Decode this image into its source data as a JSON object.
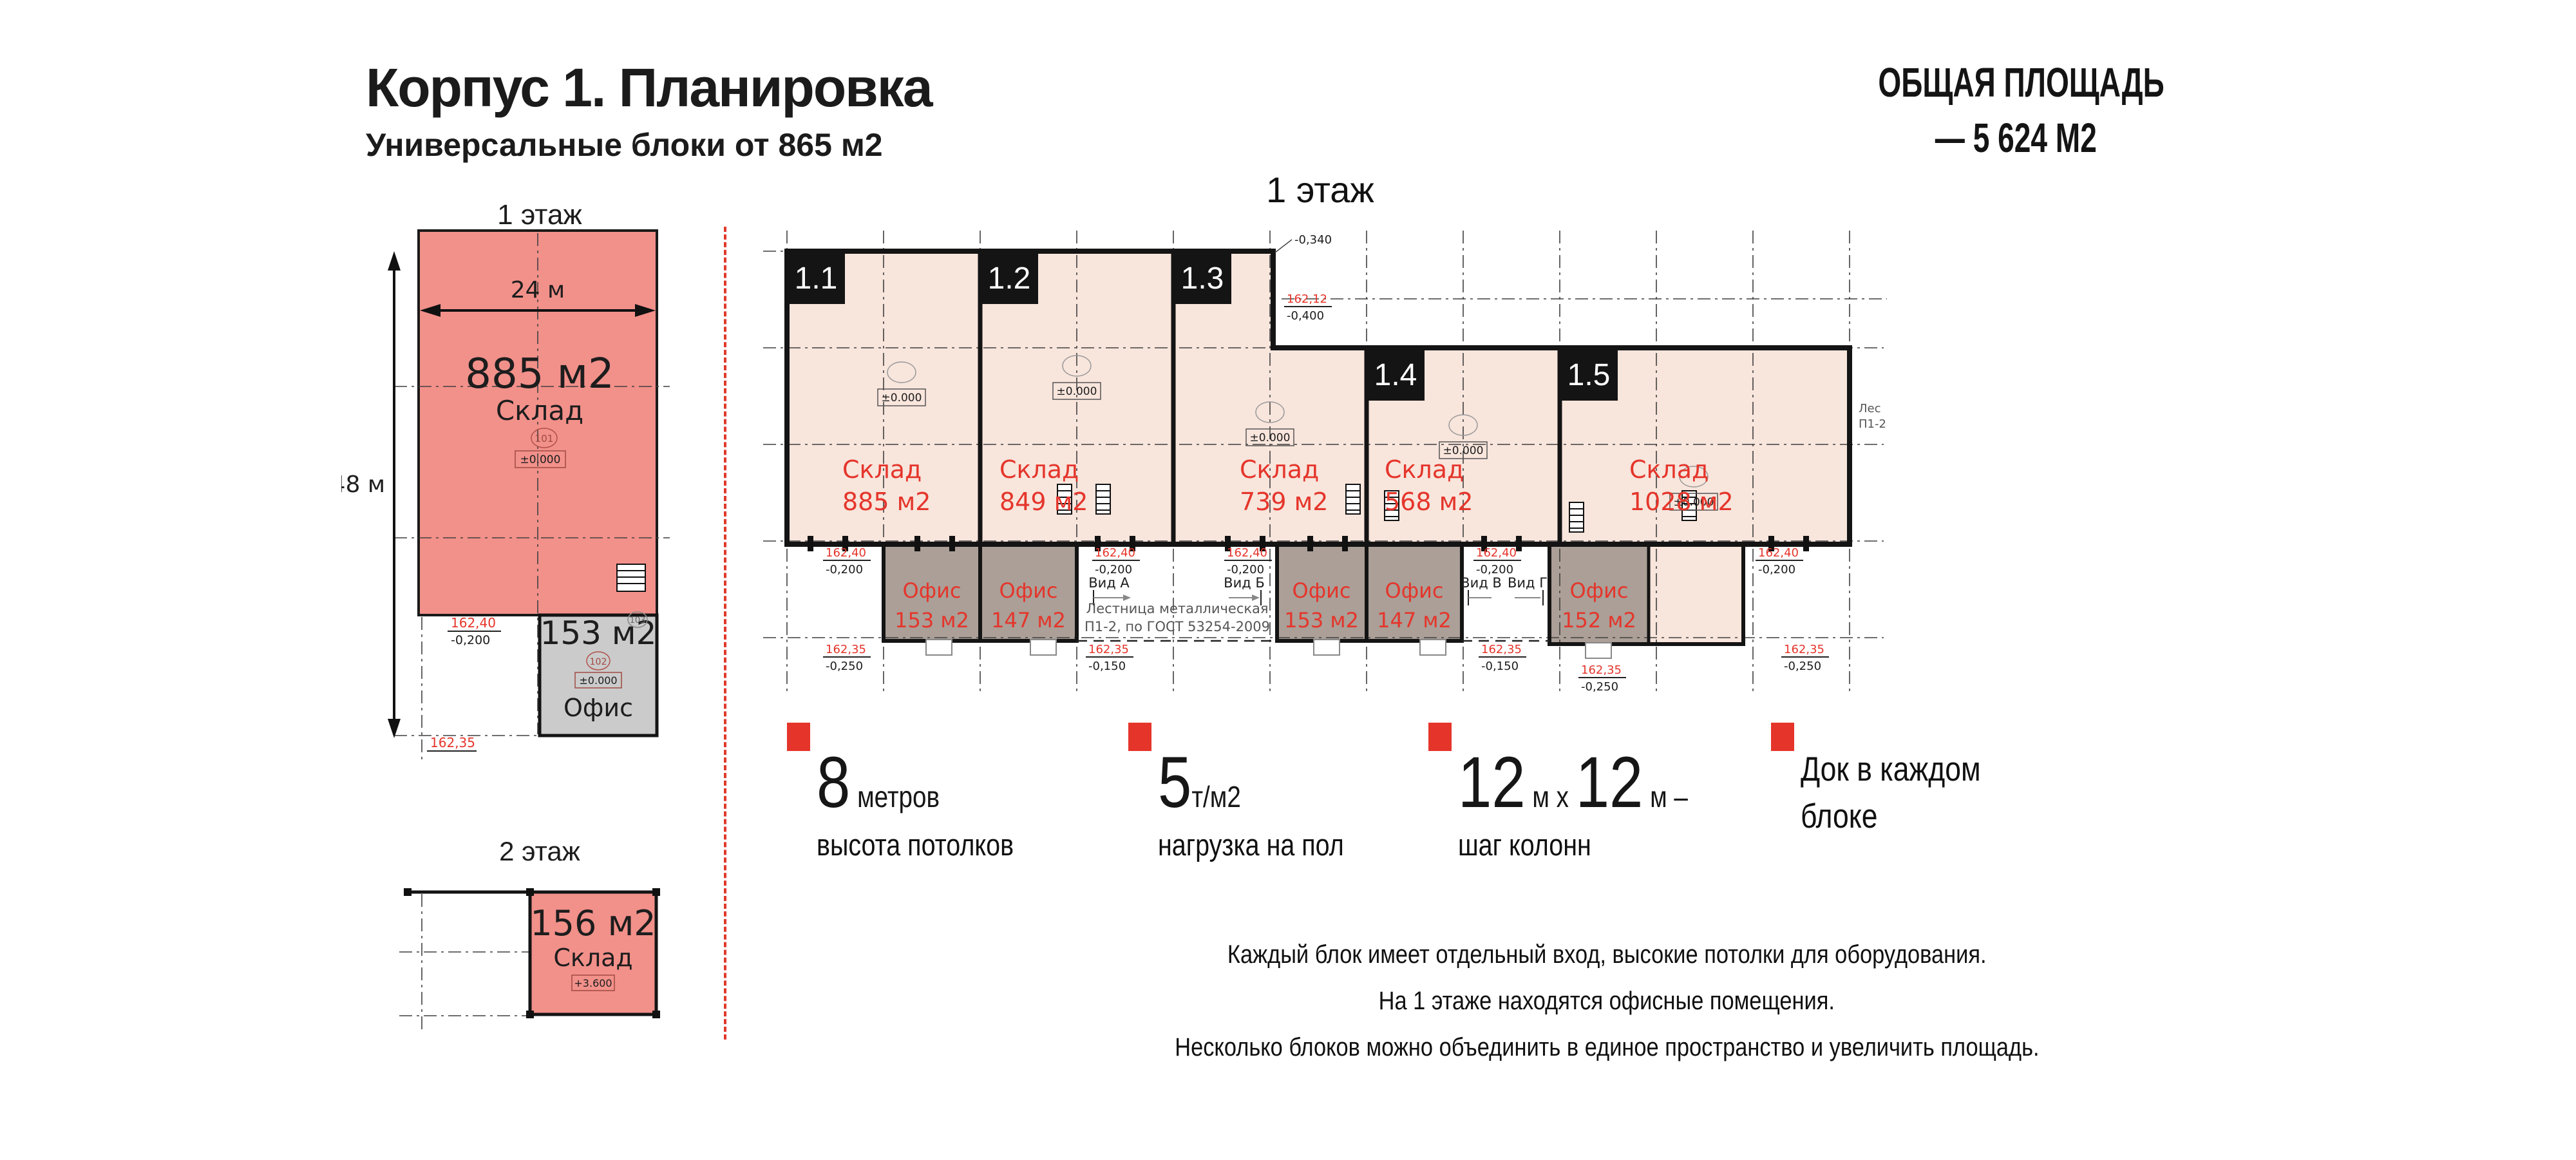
{
  "header": {
    "title": "Корпус 1. Планировка",
    "subtitle": "Универсальные блоки от 865 м2"
  },
  "total_area": {
    "line1": "ОБЩАЯ ПЛОЩАДЬ",
    "line2": "— 5 624 М2"
  },
  "mini_floor1": {
    "title": "1 этаж",
    "warehouse_area": "885 м2",
    "warehouse_label": "Склад",
    "office_area": "153 м2",
    "office_label": "Офис",
    "dim_width": "24 м",
    "dim_height": "48 м",
    "room1": "101",
    "room2": "102",
    "room3": "103",
    "elev": "±0.000",
    "mark_top_v": "162,40",
    "mark_top_d": "-0,200",
    "mark_bottom": "162,35"
  },
  "mini_floor2": {
    "title": "2 этаж",
    "warehouse_area": "156 м2",
    "warehouse_label": "Склад",
    "elev": "+3.600"
  },
  "main_plan": {
    "title": "1 этаж",
    "blocks": [
      {
        "id": "1.1",
        "label": "Склад",
        "area": "885 м2"
      },
      {
        "id": "1.2",
        "label": "Склад",
        "area": "849 м2"
      },
      {
        "id": "1.3",
        "label": "Склад",
        "area": "739 м2"
      },
      {
        "id": "1.4",
        "label": "Склад",
        "area": "568 м2"
      },
      {
        "id": "1.5",
        "label": "Склад",
        "area": "1028 м2"
      }
    ],
    "offices": [
      {
        "label": "Офис",
        "area": "153 м2"
      },
      {
        "label": "Офис",
        "area": "147 м2"
      },
      {
        "label": "Офис",
        "area": "153 м2"
      },
      {
        "label": "Офис",
        "area": "147 м2"
      },
      {
        "label": "Офис",
        "area": "152 м2"
      }
    ],
    "views": [
      "Вид А",
      "Вид Б",
      "Вид В",
      "Вид Г"
    ],
    "stair_note1": "Лестница металлическая",
    "stair_note2": "П1-2, по ГОСТ 53254-2009",
    "side_note1": "Лес",
    "side_note2": "П1-2",
    "elev_zero": "±0.000",
    "elev_top_v": "162,40",
    "elev_top_d": "-0,200",
    "elev_bot_v": "162,35",
    "elev_bot_d1": "-0,150",
    "elev_bot_d2": "-0,250",
    "elev_step_v": "162,12",
    "elev_step_d": "-0,400",
    "mark_340": "-0,340"
  },
  "features": [
    {
      "num": "8",
      "unit": " метров",
      "caption": "высота потолков"
    },
    {
      "num": "5",
      "unit": "т/м2",
      "caption": "нагрузка на пол"
    },
    {
      "num": "12",
      "unit": " м x ",
      "num2": "12",
      "unit2": " м –",
      "caption": "шаг колонн"
    },
    {
      "line1": "Док в каждом",
      "line2": "блоке"
    }
  ],
  "footer": {
    "line1": "Каждый блок имеет отдельный вход, высокие потолки для оборудования.",
    "line2": "На 1 этаже находятся офисные помещения.",
    "line3": "Несколько блоков можно объединить в единое пространство и увеличить площадь."
  },
  "colors": {
    "accent_red": "#e5352b",
    "plan_pink": "#f8e5dc",
    "mini_red": "#f2908a",
    "office_taupe": "#ab9f97",
    "mini_office_gray": "#cbcbcb",
    "label_black": "#141414"
  }
}
